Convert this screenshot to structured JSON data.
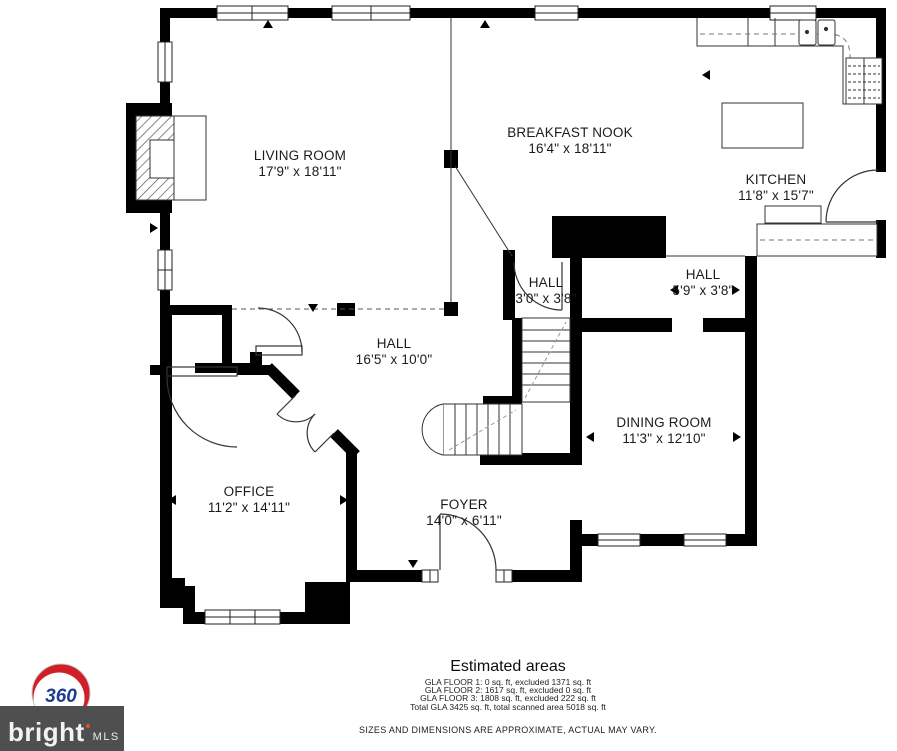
{
  "plan": {
    "rooms": [
      {
        "name": "LIVING ROOM",
        "dims": "17'9\" x 18'11\""
      },
      {
        "name": "BREAKFAST NOOK",
        "dims": "16'4\" x 18'11\""
      },
      {
        "name": "KITCHEN",
        "dims": "11'8\" x 15'7\""
      },
      {
        "name": "HALL",
        "dims": "3'0\" x 3'8\""
      },
      {
        "name": "HALL",
        "dims": "5'9\" x 3'8\""
      },
      {
        "name": "HALL",
        "dims": "16'5\" x 10'0\""
      },
      {
        "name": "DINING ROOM",
        "dims": "11'3\" x 12'10\""
      },
      {
        "name": "OFFICE",
        "dims": "11'2\" x 14'11\""
      },
      {
        "name": "FOYER",
        "dims": "14'0\" x 6'11\""
      }
    ],
    "wall_color": "#000000",
    "line_color": "#333333"
  },
  "footer": {
    "title": "Estimated areas",
    "area_lines": [
      "GLA FLOOR 1: 0 sq. ft, excluded 1371 sq. ft",
      "GLA FLOOR 2: 1617 sq. ft, excluded 0 sq. ft",
      "GLA FLOOR 3: 1808 sq. ft, excluded 222 sq. ft",
      "Total GLA 3425 sq. ft, total scanned area 5018 sq. ft"
    ],
    "disclaimer": "SIZES AND DIMENSIONS ARE APPROXIMATE, ACTUAL MAY VARY."
  },
  "branding": {
    "badge_text": "360",
    "brand_name": "bright",
    "brand_suffix": "MLS",
    "bar_color": "#4f4f4f",
    "badge_red": "#cf2028",
    "badge_blue": "#1d3e8e"
  }
}
